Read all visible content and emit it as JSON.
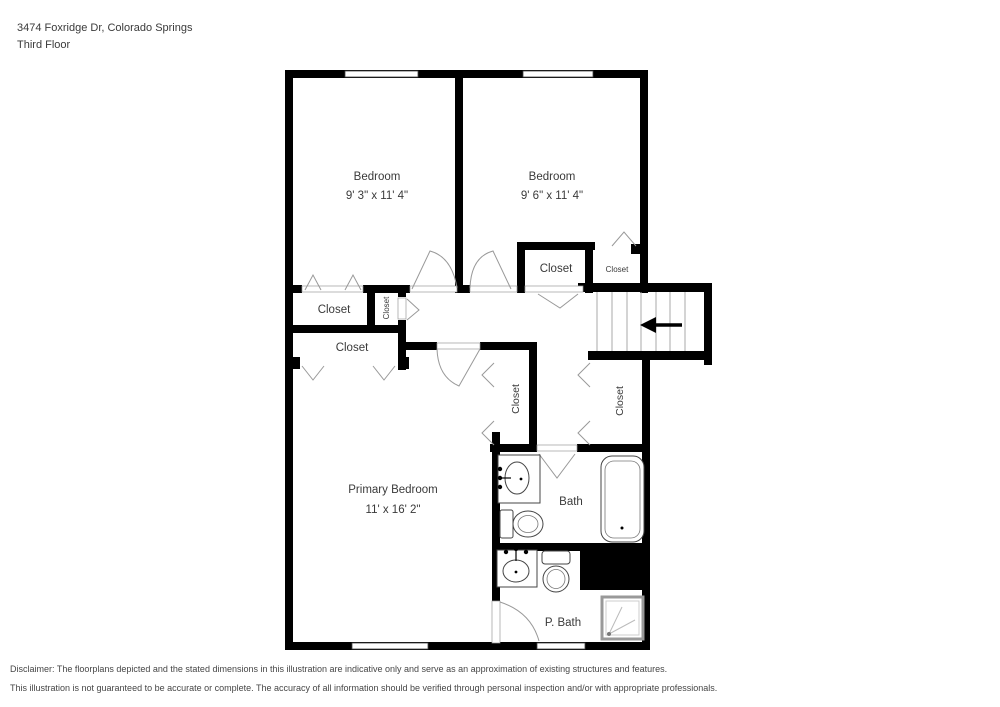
{
  "header": {
    "address": "3474 Foxridge Dr, Colorado Springs",
    "floor_label": "Third Floor"
  },
  "plan": {
    "bedroom_left": {
      "label": "Bedroom",
      "dims": "9' 3\" x 11' 4\""
    },
    "bedroom_right": {
      "label": "Bedroom",
      "dims": "9' 6\" x 11' 4\""
    },
    "primary_bedroom": {
      "label": "Primary Bedroom",
      "dims": "11' x 16' 2\""
    },
    "bath": {
      "label": "Bath"
    },
    "primary_bath": {
      "label": "P. Bath"
    },
    "closet_label": "Closet"
  },
  "disclaimer": {
    "line1": "Disclaimer: The floorplans depicted and the stated dimensions in this illustration are indicative only and serve as an approximation of existing structures and features.",
    "line2": "This illustration is not guaranteed to be accurate or complete. The accuracy of all information should be verified through personal inspection and/or with appropriate professionals."
  },
  "colors": {
    "wall": "#000000",
    "text": "#3a3a3a",
    "door_line": "#999999"
  }
}
